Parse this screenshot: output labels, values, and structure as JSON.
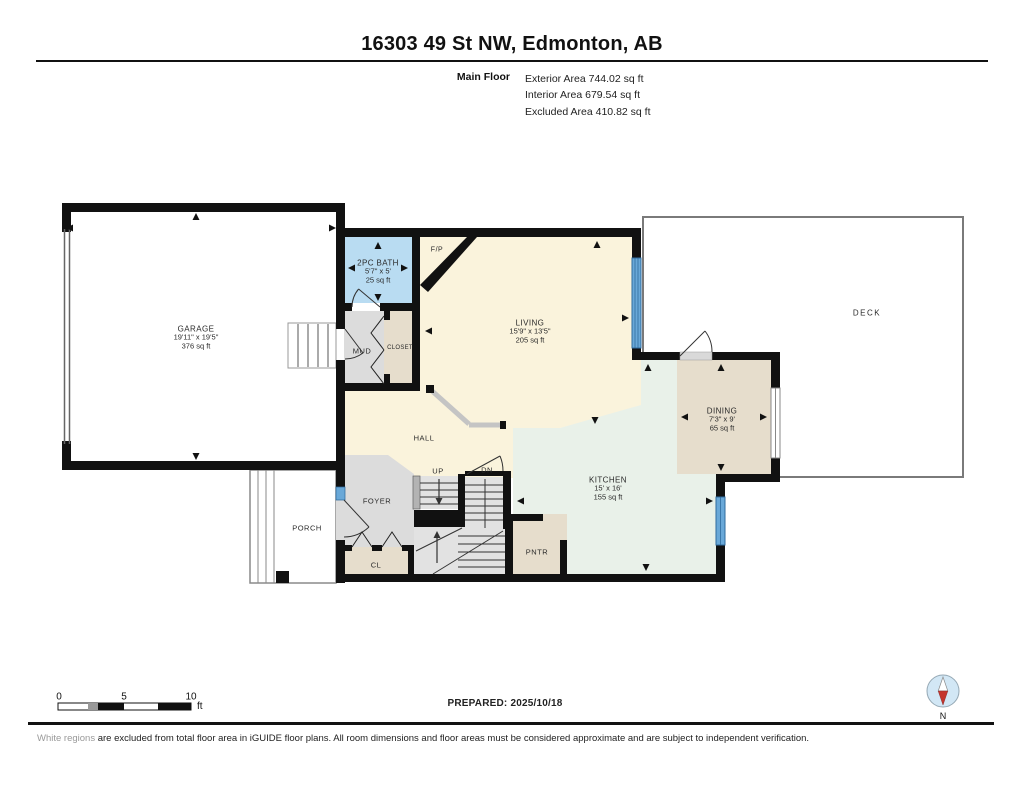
{
  "header": {
    "title": "16303 49 St NW, Edmonton, AB",
    "floor_label": "Main Floor",
    "stats": [
      "Exterior Area 744.02 sq ft",
      "Interior Area 679.54 sq ft",
      "Excluded Area 410.82 sq ft"
    ]
  },
  "rooms": {
    "garage": {
      "name": "GARAGE",
      "dims": "19'11\" x 19'5\"",
      "area": "376 sq ft"
    },
    "bath": {
      "name": "2PC BATH",
      "dims": "5'7\" x 5'",
      "area": "25 sq ft"
    },
    "living": {
      "name": "LIVING",
      "dims": "15'9\" x 13'5\"",
      "area": "205 sq ft"
    },
    "dining": {
      "name": "DINING",
      "dims": "7'3\" x 9'",
      "area": "65 sq ft"
    },
    "kitchen": {
      "name": "KITCHEN",
      "dims": "15' x 16'",
      "area": "155 sq ft"
    },
    "deck": {
      "name": "DECK"
    },
    "mud": {
      "name": "MUD"
    },
    "closet": {
      "name": "CLOSET"
    },
    "hall": {
      "name": "HALL"
    },
    "foyer": {
      "name": "FOYER"
    },
    "porch": {
      "name": "PORCH"
    },
    "pantry": {
      "name": "PNTR"
    },
    "cl": {
      "name": "CL"
    },
    "fireplace": {
      "name": "F/P"
    },
    "stairs_up": {
      "name": "UP"
    },
    "stairs_dn": {
      "name": "DN"
    }
  },
  "scale_bar": {
    "tick_0": "0",
    "tick_5": "5",
    "tick_10": "10",
    "unit": "ft"
  },
  "footer": {
    "prepared": "PREPARED: 2025/10/18",
    "disclaimer_highlight": "White regions",
    "disclaimer_rest": " are excluded from total floor area in iGUIDE floor plans. All room dimensions and floor areas must be considered approximate and are subject to independent verification.",
    "compass_label": "N"
  },
  "colors": {
    "wall": "#111111",
    "floor_cream": "#faf3dc",
    "floor_bath_blue": "#b9dcf2",
    "floor_gray": "#dcdcdc",
    "floor_tan": "#e6ddcc",
    "floor_mint": "#e9f1e9",
    "window_blue": "#69a8d8",
    "compass_red": "#c4342c"
  }
}
